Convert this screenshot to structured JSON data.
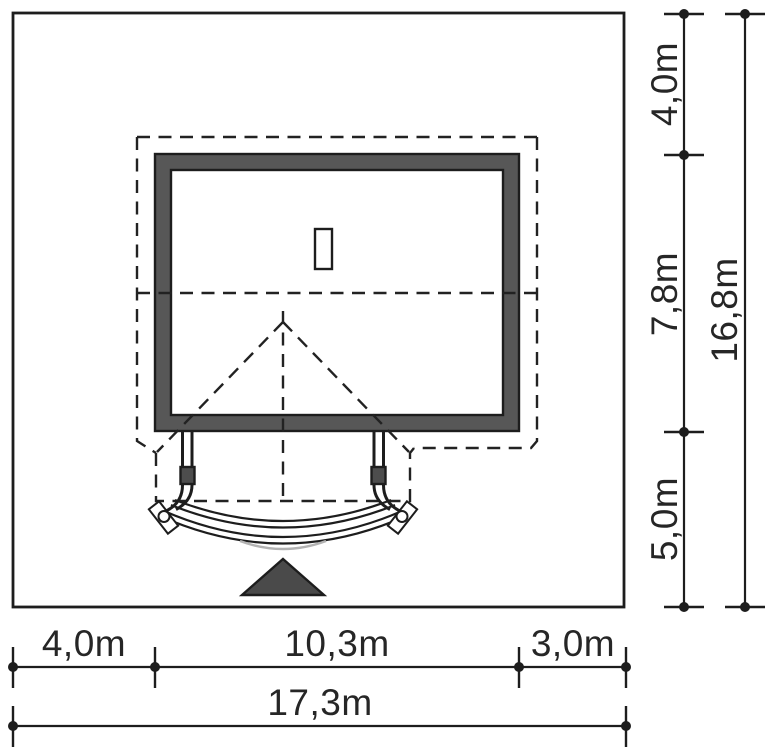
{
  "drawing": {
    "description": "Architectural site plan: plot with house footprint, dashed roof outline, entrance canopy with columns and curved steps, north-style entrance marker, dimension chains on right and bottom",
    "background": "#ffffff",
    "line_color": "#1d1d1d",
    "wall_fill": "#575757",
    "block_fill": "#4d4d4d",
    "marker_fill": "#4a4a4a"
  },
  "dimensions_bottom": {
    "segments": [
      {
        "label": "4,0m",
        "meters": 4.0
      },
      {
        "label": "10,3m",
        "meters": 10.3
      },
      {
        "label": "3,0m",
        "meters": 3.0
      }
    ],
    "total": {
      "label": "17,3m",
      "meters": 17.3
    }
  },
  "dimensions_right": {
    "segments": [
      {
        "label": "4,0m",
        "meters": 4.0
      },
      {
        "label": "7,8m",
        "meters": 7.8
      },
      {
        "label": "5,0m",
        "meters": 5.0
      }
    ],
    "total": {
      "label": "16,8m",
      "meters": 16.8
    }
  }
}
